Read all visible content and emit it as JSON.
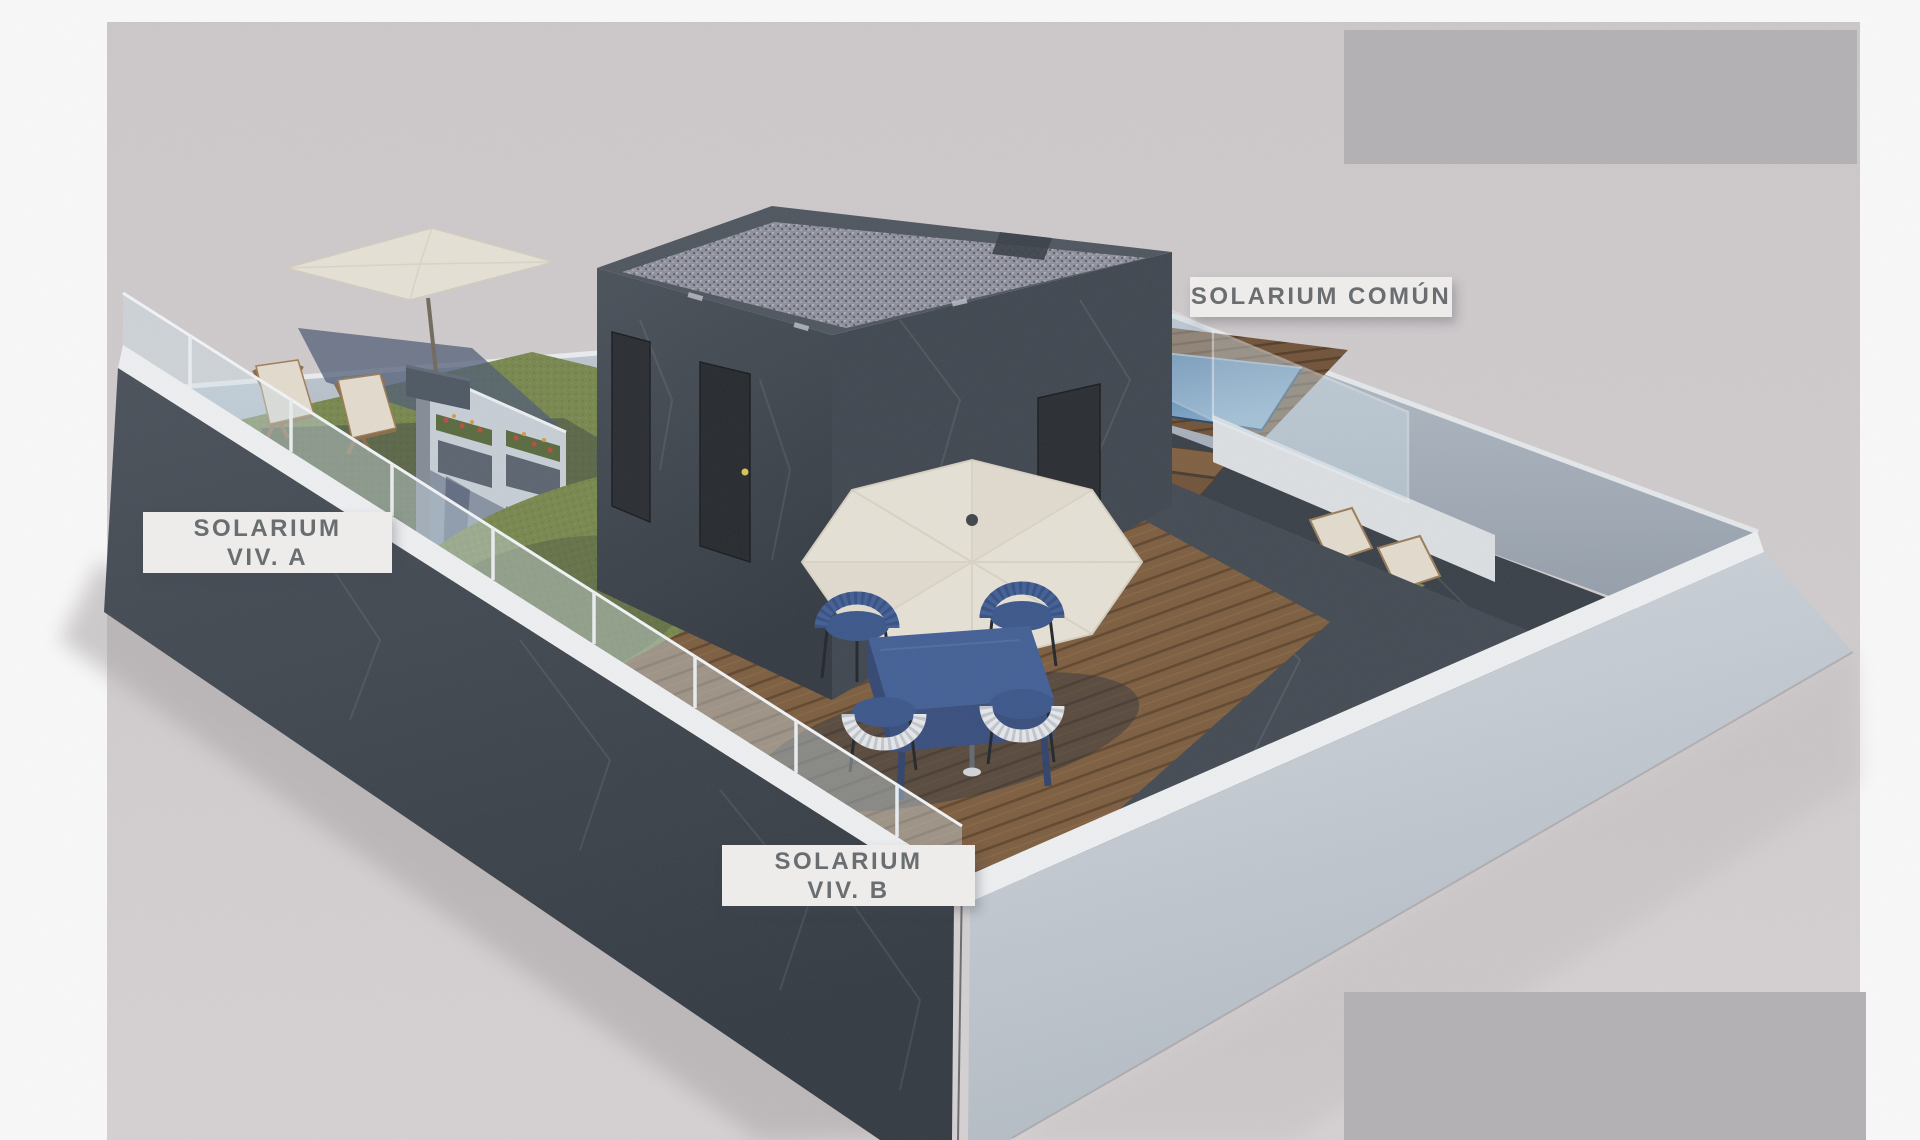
{
  "labels": {
    "solarium_comun": "SOLARIUM COMÚN",
    "solarium_viv_a_line1": "SOLARIUM",
    "solarium_viv_a_line2": "VIV. A",
    "solarium_viv_b_line1": "SOLARIUM",
    "solarium_viv_b_line2": "VIV. B"
  },
  "colors": {
    "page_bg": "#ffffff",
    "backdrop_top": "#cfcacc",
    "backdrop_bottom": "#d9d5d6",
    "label_bg": "#edecea",
    "label_text": "#6a6e71",
    "placeholder_gray": "#b4b1b4",
    "wall_dark": "#3e464f",
    "wall_light_face": "#ccd3da",
    "wall_interior": "#b9c3cd",
    "cap_white": "#f2f4f6",
    "deck_wood": "#7b5a3a",
    "deck_wood_dark": "#5d4228",
    "grass": "#76864a",
    "grass_shadow": "#46503a",
    "pool_water": "#3a6a99",
    "parasol_cream": "#eae5d8",
    "furniture_blue": "#3d5c94",
    "chair_white": "#e9ebee",
    "glass_tint": "#cfe2ec",
    "stucco": "#dfe3e6",
    "door_dark": "#23272c",
    "flower_red": "#b84a3a"
  }
}
